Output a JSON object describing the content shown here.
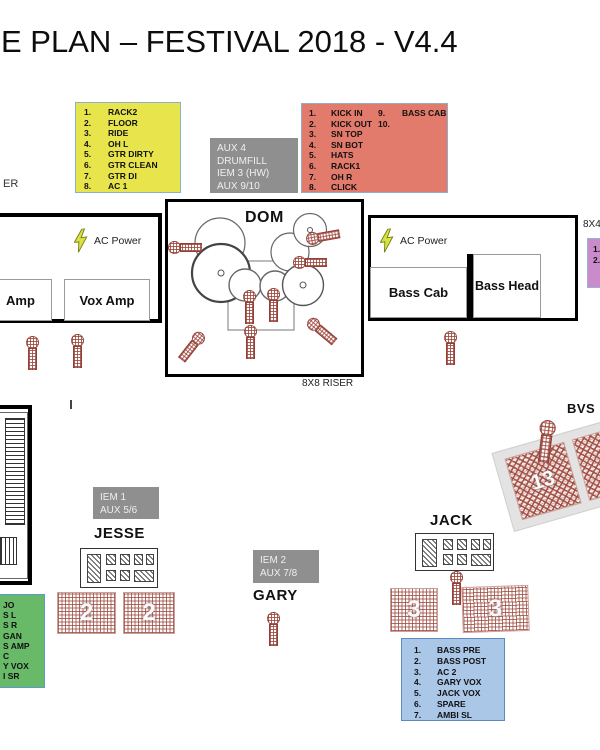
{
  "title": "E PLAN – FESTIVAL 2018 - V4.4",
  "labels": {
    "dom": "DOM",
    "drum_riser": "8X8 RISER",
    "left_riser_fragment": "ER",
    "right_riser_fragment": "8X4",
    "ac_power": "AC Power",
    "amp_fragment": "Amp",
    "vox_amp": "Vox Amp",
    "bass_cab": "Bass Cab",
    "bass_head": "Bass Head",
    "jesse": "JESSE",
    "gary": "GARY",
    "jack": "JACK",
    "bvs": "BVS"
  },
  "iem": {
    "iem1": {
      "l1": "IEM 1",
      "l2": "AUX 5/6"
    },
    "iem2": {
      "l1": "IEM 2",
      "l2": "AUX 7/8"
    },
    "drumfill": {
      "l1": "AUX 4",
      "l2": "DRUMFILL",
      "l3": "IEM 3 (HW)",
      "l4": "AUX 9/10"
    }
  },
  "monitors": {
    "jesse_left": "2",
    "jesse_right": "2",
    "jack_left": "3",
    "jack_right": "3",
    "bvs_wedge": "13"
  },
  "patch_yellow": {
    "items": [
      {
        "n": "1.",
        "t": "RACK2"
      },
      {
        "n": "2.",
        "t": "FLOOR"
      },
      {
        "n": "3.",
        "t": "RIDE"
      },
      {
        "n": "4.",
        "t": "OH L"
      },
      {
        "n": "5.",
        "t": "GTR DIRTY"
      },
      {
        "n": "6.",
        "t": "GTR CLEAN"
      },
      {
        "n": "7.",
        "t": "GTR DI"
      },
      {
        "n": "8.",
        "t": "AC 1"
      }
    ]
  },
  "patch_red": {
    "items": [
      {
        "n": "1.",
        "t": "KICK IN"
      },
      {
        "n": "2.",
        "t": "KICK OUT"
      },
      {
        "n": "3.",
        "t": "SN TOP"
      },
      {
        "n": "4.",
        "t": "SN BOT"
      },
      {
        "n": "5.",
        "t": "HATS"
      },
      {
        "n": "6.",
        "t": "RACK1"
      },
      {
        "n": "7.",
        "t": "OH R"
      },
      {
        "n": "8.",
        "t": "CLICK"
      }
    ],
    "extra": [
      {
        "n": "9.",
        "t": "BASS CAB"
      },
      {
        "n": "10.",
        "t": ""
      }
    ]
  },
  "patch_blue": {
    "items": [
      {
        "n": "1.",
        "t": "BASS PRE"
      },
      {
        "n": "2.",
        "t": "BASS POST"
      },
      {
        "n": "3.",
        "t": "AC 2"
      },
      {
        "n": "4.",
        "t": "GARY VOX"
      },
      {
        "n": "5.",
        "t": "JACK VOX"
      },
      {
        "n": "6.",
        "t": "SPARE"
      },
      {
        "n": "7.",
        "t": "AMBI SL"
      }
    ]
  },
  "patch_green": {
    "lines": [
      "JO",
      "S L",
      "S R",
      "GAN",
      "S AMP",
      "C",
      "Y VOX",
      "I SR"
    ]
  },
  "patch_purple": {
    "lines": [
      "1.",
      "2."
    ]
  },
  "colors": {
    "yellow_box": "#e7e44c",
    "red_box": "#e37b6c",
    "gray_box": "#8f8f8f",
    "green_box": "#68b968",
    "blue_box": "#aac7e8",
    "purple_box": "#c98bc9",
    "hatch_red": "#9e4a40",
    "bolt_yellow": "#dbe23d"
  }
}
